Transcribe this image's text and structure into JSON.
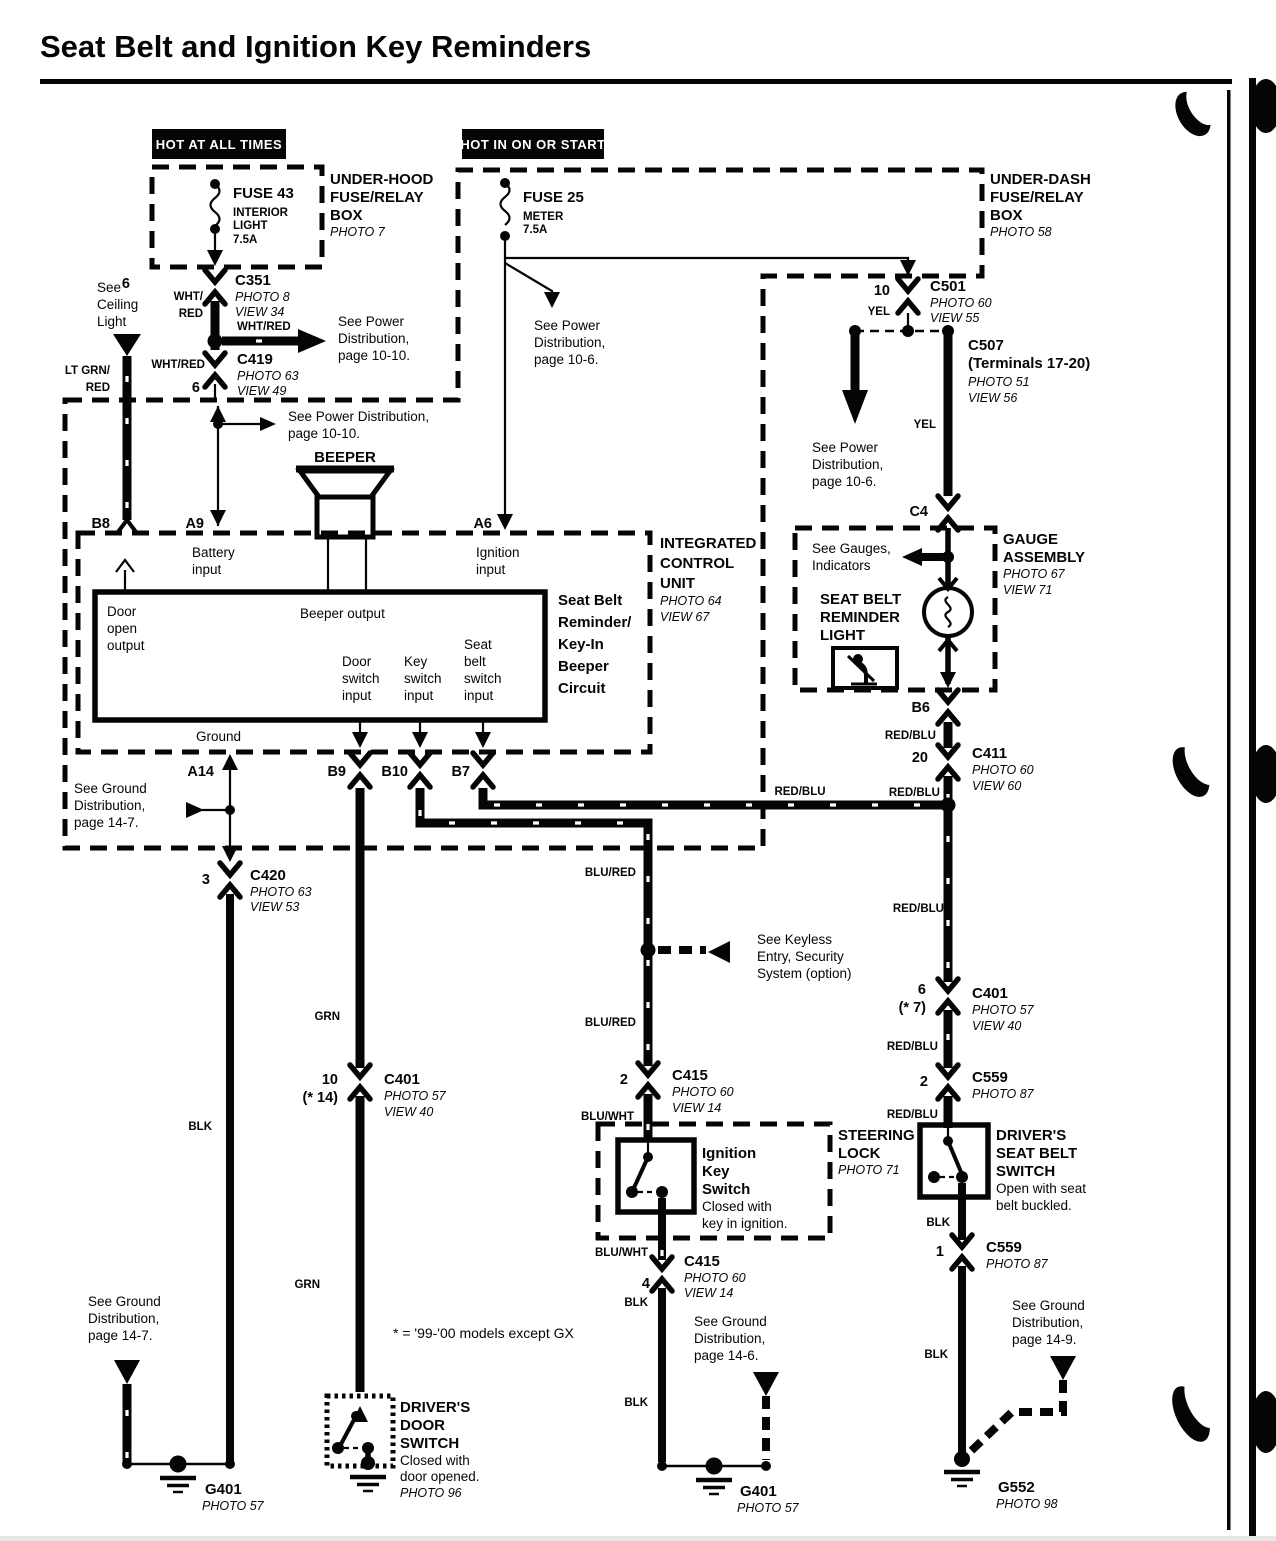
{
  "title": "Seat Belt and Ignition Key Reminders",
  "banners": {
    "hot_all_times": "HOT AT ALL TIMES",
    "hot_on_start": "HOT IN ON OR START"
  },
  "boxes": {
    "underhood": {
      "l1": "UNDER-HOOD",
      "l2": "FUSE/RELAY",
      "l3": "BOX",
      "photo": "PHOTO 7"
    },
    "underdash": {
      "l1": "UNDER-DASH",
      "l2": "FUSE/RELAY",
      "l3": "BOX",
      "photo": "PHOTO 58"
    },
    "gauge": {
      "l1": "GAUGE",
      "l2": "ASSEMBLY",
      "photo": "PHOTO 67",
      "view": "VIEW 71"
    },
    "icu": {
      "l1": "INTEGRATED",
      "l2": "CONTROL",
      "l3": "UNIT",
      "photo": "PHOTO 64",
      "view": "VIEW 67"
    },
    "steering": {
      "l1": "STEERING",
      "l2": "LOCK",
      "photo": "PHOTO 71"
    }
  },
  "fuses": {
    "fuse43": {
      "name": "FUSE 43",
      "d1": "INTERIOR",
      "d2": "LIGHT",
      "amp": "7.5A"
    },
    "fuse25": {
      "name": "FUSE 25",
      "d1": "METER",
      "amp": "7.5A"
    }
  },
  "connectors": {
    "c351": {
      "pin": "6",
      "name": "C351",
      "photo": "PHOTO 8",
      "view": "VIEW 34"
    },
    "c419": {
      "pin": "6",
      "name": "C419",
      "photo": "PHOTO 63",
      "view": "VIEW 49"
    },
    "c501": {
      "pin": "10",
      "name": "C501",
      "photo": "PHOTO 60",
      "view": "VIEW 55"
    },
    "c507": {
      "name": "C507",
      "sub": "(Terminals 17-20)",
      "photo": "PHOTO 51",
      "view": "VIEW 56"
    },
    "c411": {
      "pin": "20",
      "name": "C411",
      "photo": "PHOTO 60",
      "view": "VIEW 60"
    },
    "c401_right": {
      "pin": "6",
      "note": "(* 7)",
      "name": "C401",
      "photo": "PHOTO 57",
      "view": "VIEW 40"
    },
    "c401_left": {
      "pin": "10",
      "note": "(* 14)",
      "name": "C401",
      "photo": "PHOTO 57",
      "view": "VIEW 40"
    },
    "c415_top": {
      "pin": "2",
      "name": "C415",
      "photo": "PHOTO 60",
      "view": "VIEW 14"
    },
    "c415_bottom": {
      "pin": "4",
      "name": "C415",
      "photo": "PHOTO 60",
      "view": "VIEW 14"
    },
    "c559_top": {
      "pin": "2",
      "name": "C559",
      "photo": "PHOTO 87"
    },
    "c559_bottom": {
      "pin": "1",
      "name": "C559",
      "photo": "PHOTO 87"
    },
    "c420": {
      "pin": "3",
      "name": "C420",
      "photo": "PHOTO 63",
      "view": "VIEW 53"
    },
    "c4": "C4"
  },
  "grounds": {
    "g401_left": {
      "name": "G401",
      "photo": "PHOTO 57"
    },
    "g401_mid": {
      "name": "G401",
      "photo": "PHOTO 57"
    },
    "g552": {
      "name": "G552",
      "photo": "PHOTO 98"
    }
  },
  "pins": {
    "b8": "B8",
    "a9": "A9",
    "a6": "A6",
    "a14": "A14",
    "b9": "B9",
    "b10": "B10",
    "b7": "B7",
    "b6": "B6"
  },
  "wire_colors": {
    "wht_red": "WHT/RED",
    "wht": "WHT/",
    "red": "RED",
    "lt_grn": "LT GRN/",
    "yel": "YEL",
    "red_blu": "RED/BLU",
    "blu_red": "BLU/RED",
    "blu_wht": "BLU/WHT",
    "grn": "GRN",
    "blk": "BLK"
  },
  "refs": {
    "ceiling": {
      "l1": "See",
      "l2": "Ceiling",
      "l3": "Light"
    },
    "power_1010_a": {
      "l1": "See Power",
      "l2": "Distribution,",
      "l3": "page 10-10."
    },
    "power_1010_b": {
      "l1": "See Power Distribution,",
      "l2": "page 10-10."
    },
    "power_106_a": {
      "l1": "See Power",
      "l2": "Distribution,",
      "l3": "page 10-6."
    },
    "power_106_b": {
      "l1": "See Power",
      "l2": "Distribution,",
      "l3": "page 10-6."
    },
    "ground_147_a": {
      "l1": "See Ground",
      "l2": "Distribution,",
      "l3": "page 14-7."
    },
    "ground_147_b": {
      "l1": "See Ground",
      "l2": "Distribution,",
      "l3": "page 14-7."
    },
    "ground_146": {
      "l1": "See Ground",
      "l2": "Distribution,",
      "l3": "page 14-6."
    },
    "ground_149": {
      "l1": "See Ground",
      "l2": "Distribution,",
      "l3": "page 14-9."
    },
    "keyless": {
      "l1": "See Keyless",
      "l2": "Entry, Security",
      "l3": "System (option)"
    },
    "gauges": {
      "l1": "See Gauges,",
      "l2": "Indicators"
    }
  },
  "icu": {
    "battery": {
      "l1": "Battery",
      "l2": "input"
    },
    "ignition": {
      "l1": "Ignition",
      "l2": "input"
    },
    "door_open": {
      "l1": "Door",
      "l2": "open",
      "l3": "output"
    },
    "beeper_output": "Beeper output",
    "door_switch": {
      "l1": "Door",
      "l2": "switch",
      "l3": "input"
    },
    "key_switch": {
      "l1": "Key",
      "l2": "switch",
      "l3": "input"
    },
    "belt_switch": {
      "l1": "Seat",
      "l2": "belt",
      "l3": "switch",
      "l4": "input"
    },
    "ground": "Ground",
    "circuit": {
      "l1": "Seat Belt",
      "l2": "Reminder/",
      "l3": "Key-In",
      "l4": "Beeper",
      "l5": "Circuit"
    }
  },
  "devices": {
    "beeper": "BEEPER",
    "reminder_light": {
      "l1": "SEAT BELT",
      "l2": "REMINDER",
      "l3": "LIGHT"
    },
    "ignition_key_switch": {
      "t1": "Ignition",
      "t2": "Key",
      "t3": "Switch",
      "d1": "Closed with",
      "d2": "key in ignition."
    },
    "seat_belt_switch": {
      "t1": "DRIVER'S",
      "t2": "SEAT BELT",
      "t3": "SWITCH",
      "d1": "Open with seat",
      "d2": "belt buckled."
    },
    "door_switch": {
      "t1": "DRIVER'S",
      "t2": "DOOR",
      "t3": "SWITCH",
      "d1": "Closed with",
      "d2": "door opened.",
      "photo": "PHOTO 96"
    }
  },
  "note": "* = '99-'00 models except GX"
}
